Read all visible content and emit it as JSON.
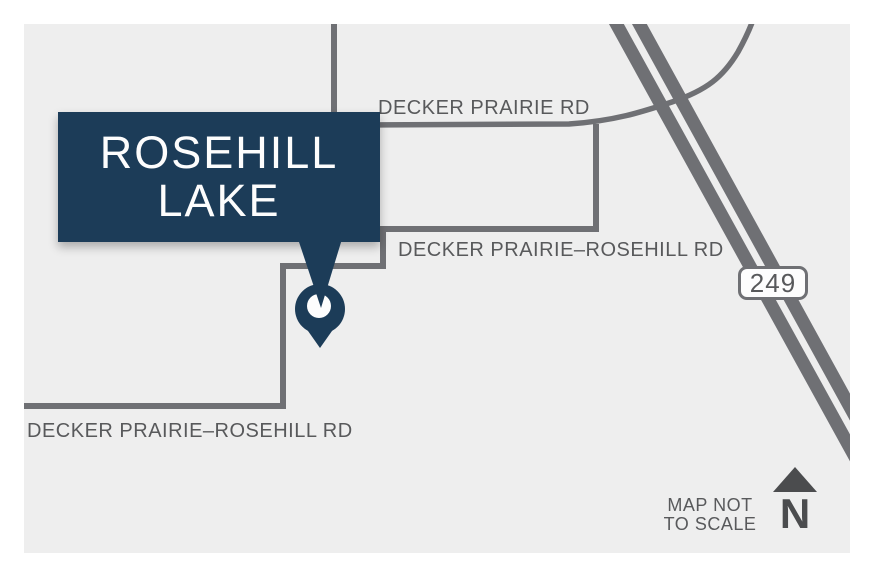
{
  "callout": {
    "line1": "ROSEHILL",
    "line2": "LAKE"
  },
  "road_labels": {
    "decker_prairie_rd": "DECKER PRAIRIE RD",
    "decker_prairie_rosehill_rd_upper": "DECKER PRAIRIE–ROSEHILL RD",
    "decker_prairie_rosehill_rd_lower": "DECKER PRAIRIE–ROSEHILL RD"
  },
  "highway_shield": {
    "number": "249"
  },
  "legend": {
    "scale_note": "MAP NOT TO SCALE",
    "north_label": "N"
  },
  "icons": {
    "pin": "location-pin",
    "north": "north-arrow",
    "shield": "route-shield"
  },
  "colors": {
    "navy": "#1c3c58",
    "road_gray": "#6f7074",
    "label_gray": "#58595b",
    "dark_gray": "#4b4c4e",
    "map_bg": "#eeeeee",
    "page_bg": "#ffffff",
    "white": "#fdfdfd"
  }
}
